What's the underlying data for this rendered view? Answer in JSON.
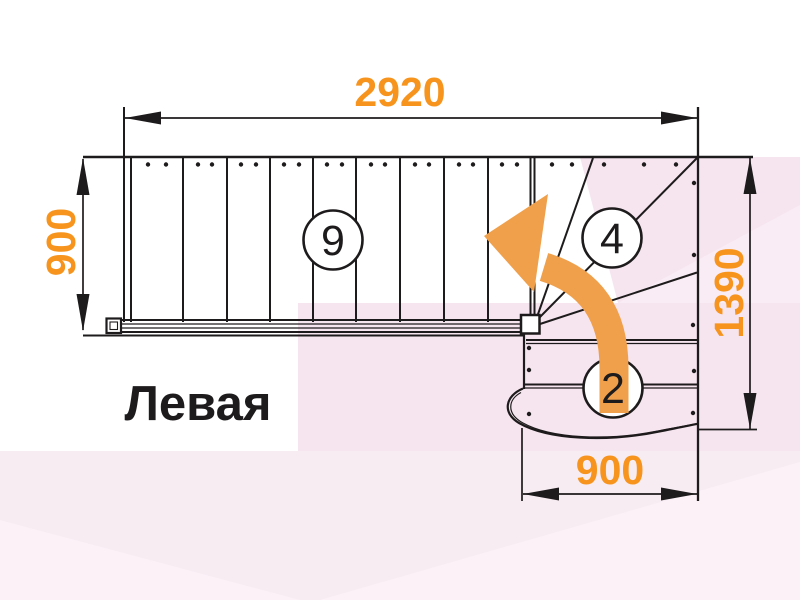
{
  "diagram": {
    "title": "Левая",
    "dimensions": {
      "top": "2920",
      "left": "900",
      "right": "1390",
      "bottom": "900"
    },
    "step_counts": {
      "upper_flight": "9",
      "winder": "4",
      "lower_flight": "2"
    },
    "colors": {
      "dimension_text": "#F7941D",
      "direction_arrow": "#F0A04B",
      "drawing_line": "#1E1B1C",
      "background": "#FFFFFF",
      "bg_pink_main": "#F6E5EF",
      "bg_pink_bottom": "#F8ECF3",
      "bg_pink_light": "#FBF1F7"
    }
  }
}
